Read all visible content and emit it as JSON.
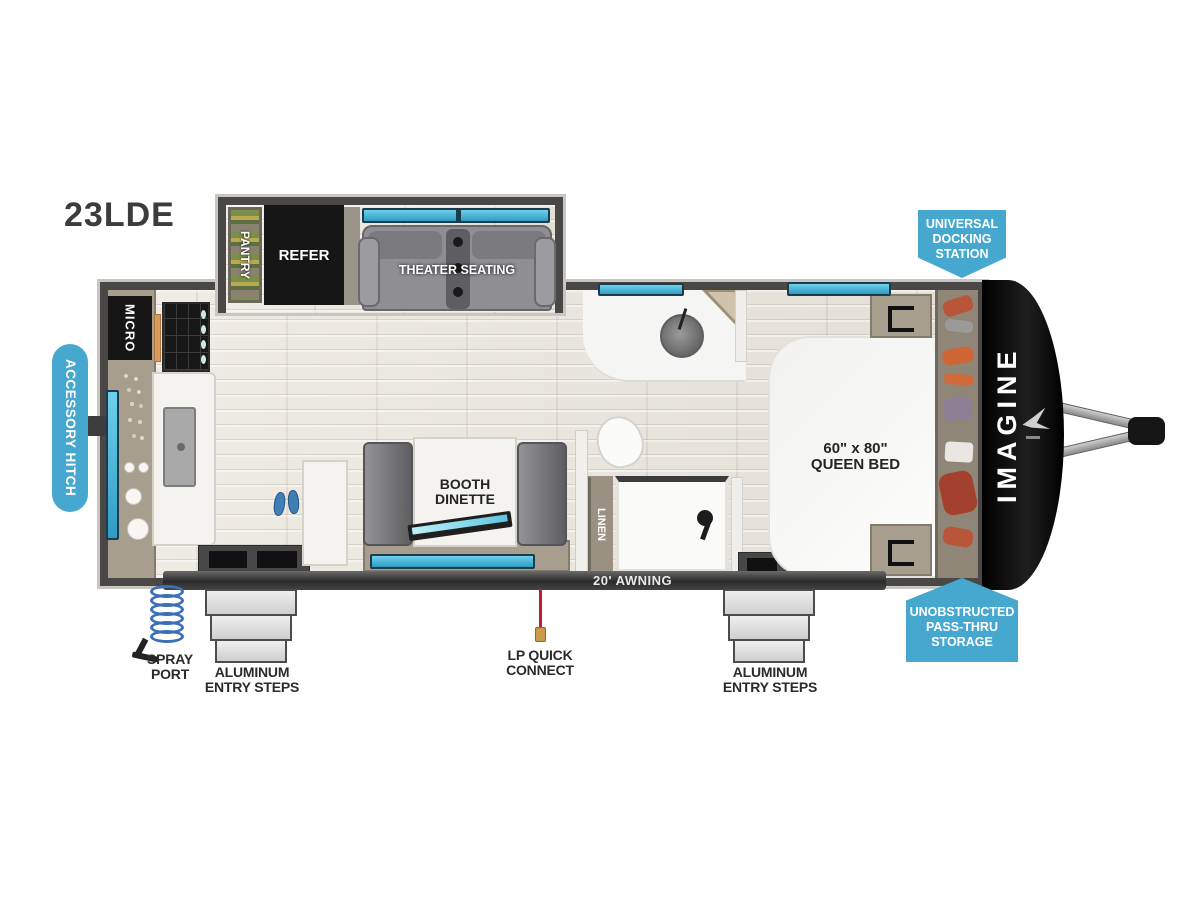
{
  "title": {
    "model": "23LDE"
  },
  "badges": {
    "docking": {
      "l1": "UNIVERSAL",
      "l2": "DOCKING",
      "l3": "STATION"
    },
    "passthru": {
      "l1": "UNOBSTRUCTED",
      "l2": "PASS-THRU",
      "l3": "STORAGE"
    },
    "accessory": {
      "label": "ACCESSORY HITCH"
    }
  },
  "interior": {
    "pantry": "PANTRY",
    "refer": "REFER",
    "micro": "MICRO",
    "theater": "THEATER SEATING",
    "dinette": {
      "l1": "BOOTH",
      "l2": "DINETTE"
    },
    "linen": "LINEN",
    "bed": {
      "l1": "60\" x 80\"",
      "l2": "QUEEN BED"
    },
    "brand": "IMAGINE"
  },
  "exterior": {
    "awning": "20' AWNING",
    "spray": {
      "l1": "SPRAY",
      "l2": "PORT"
    },
    "steps": {
      "l1": "ALUMINUM",
      "l2": "ENTRY STEPS"
    },
    "lp": {
      "l1": "LP QUICK",
      "l2": "CONNECT"
    }
  },
  "colors": {
    "badge_blue": "#47a8cf",
    "window_teal": "#4db6dc",
    "wall_gray": "#4a4846",
    "accent_black": "#161616"
  }
}
